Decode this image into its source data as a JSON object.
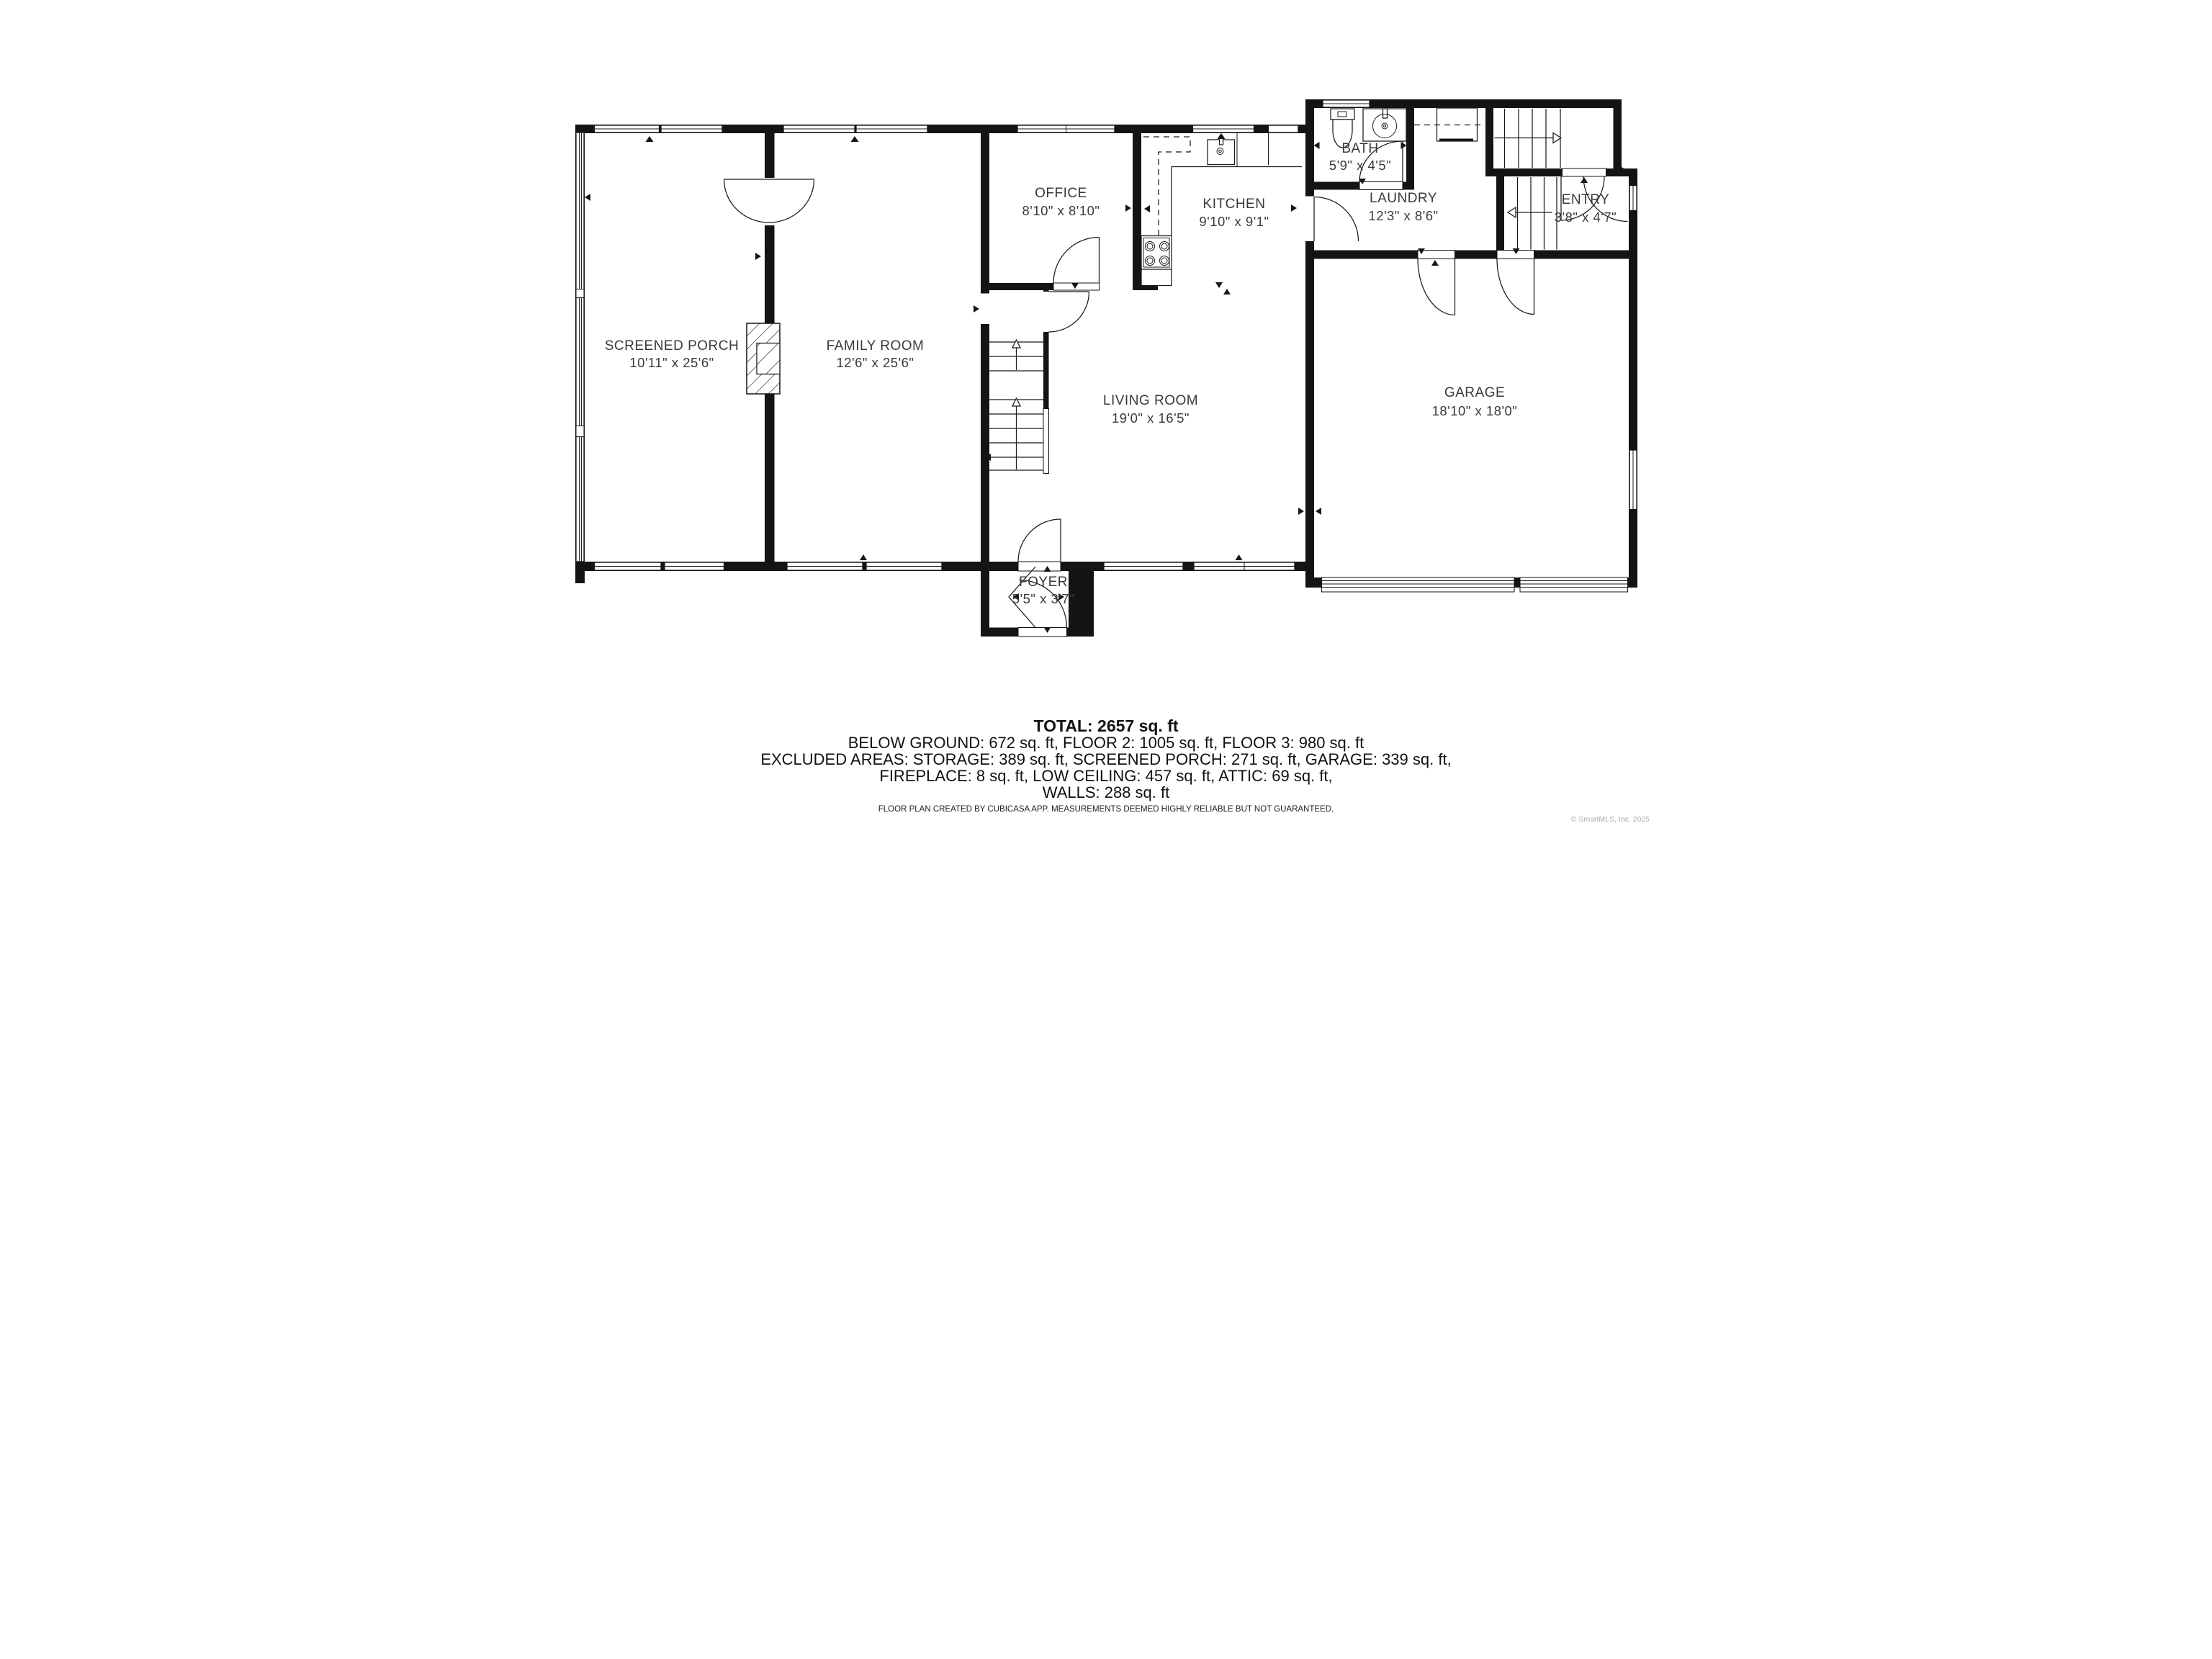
{
  "plan": {
    "source_app": "CubiCasa",
    "rooms": [
      {
        "key": "screened-porch",
        "name": "SCREENED PORCH",
        "dims": "10'11\" x 25'6\""
      },
      {
        "key": "family-room",
        "name": "FAMILY ROOM",
        "dims": "12'6\" x 25'6\""
      },
      {
        "key": "office",
        "name": "OFFICE",
        "dims": "8'10\" x 8'10\""
      },
      {
        "key": "kitchen",
        "name": "KITCHEN",
        "dims": "9'10\" x 9'1\""
      },
      {
        "key": "living-room",
        "name": "LIVING ROOM",
        "dims": "19'0\" x 16'5\""
      },
      {
        "key": "bath",
        "name": "BATH",
        "dims": "5'9\" x 4'5\""
      },
      {
        "key": "laundry",
        "name": "LAUNDRY",
        "dims": "12'3\" x 8'6\""
      },
      {
        "key": "entry",
        "name": "ENTRY",
        "dims": "3'8\" x 4'7\""
      },
      {
        "key": "garage",
        "name": "GARAGE",
        "dims": "18'10\" x 18'0\""
      },
      {
        "key": "foyer",
        "name": "FOYER",
        "dims": "5'5\" x 3'7\""
      }
    ],
    "fixtures": [
      "toilet",
      "bathroom-sink",
      "kitchen-sink",
      "stove",
      "laundry-counter",
      "fireplace"
    ],
    "stairs": [
      "main-staircase-up",
      "upper-right-staircase",
      "entry-steps"
    ]
  },
  "summary": {
    "total": "TOTAL: 2657 sq. ft",
    "lines": [
      "BELOW GROUND: 672 sq. ft, FLOOR 2: 1005 sq. ft, FLOOR 3: 980 sq. ft",
      "EXCLUDED AREAS: STORAGE: 389 sq. ft, SCREENED PORCH: 271 sq. ft, GARAGE: 339 sq. ft,",
      "FIREPLACE: 8 sq. ft, LOW CEILING: 457 sq. ft, ATTIC: 69 sq. ft,",
      "WALLS: 288 sq. ft"
    ]
  },
  "disclaimer": "FLOOR PLAN CREATED BY CUBICASA APP. MEASUREMENTS DEEMED HIGHLY RELIABLE BUT NOT GUARANTEED.",
  "copyright": "© SmartMLS, Inc. 2025"
}
